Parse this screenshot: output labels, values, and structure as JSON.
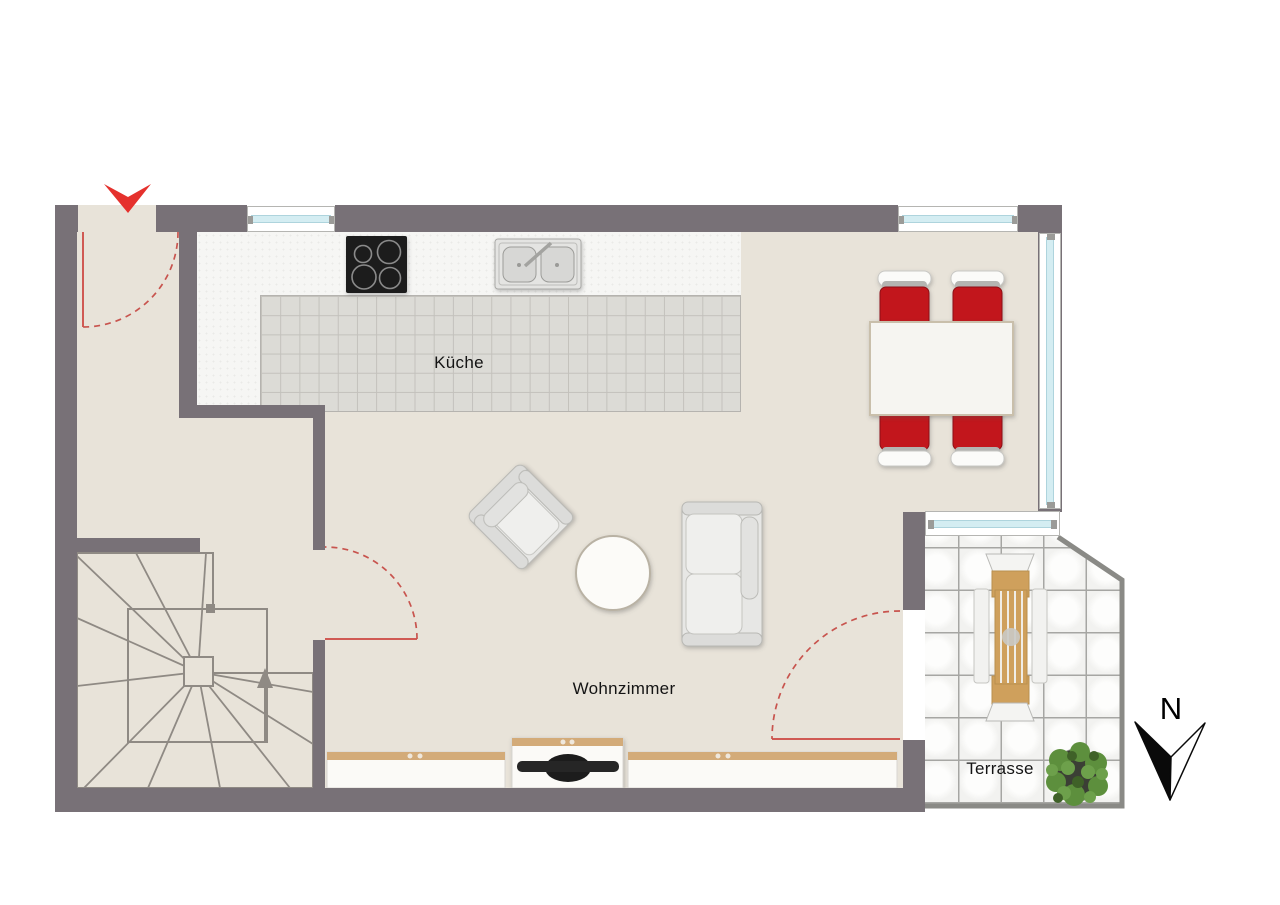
{
  "rooms": [
    {
      "id": "kueche",
      "label": "Küche"
    },
    {
      "id": "wohnzimmer",
      "label": "Wohnzimmer"
    },
    {
      "id": "terrasse",
      "label": "Terrasse"
    }
  ],
  "compass": {
    "label": "N"
  },
  "colors": {
    "wall": "#787177",
    "floor": "#e8e3d9",
    "kitchen_tile": "#dcdbd6",
    "counter_white": "#f6f6f4",
    "window_glass": "#d4edf2",
    "door_swing_red": "#c8544e",
    "door_leaf_red": "#d05a54",
    "entrance_arrow_red": "#e5312d",
    "dining_chair_red": "#c2191c",
    "terrace_wood": "#cfa05c",
    "plant_green": "#5d8f3d",
    "tv_black": "#1c1c1c"
  },
  "furniture": [
    "cooktop",
    "double-sink",
    "dining-table",
    "dining-chairs",
    "armchair",
    "coffee-table",
    "sofa",
    "sideboard",
    "tv-lowboard",
    "terrace-table",
    "terrace-benches",
    "terrace-chairs",
    "potted-plant",
    "winder-staircase"
  ]
}
